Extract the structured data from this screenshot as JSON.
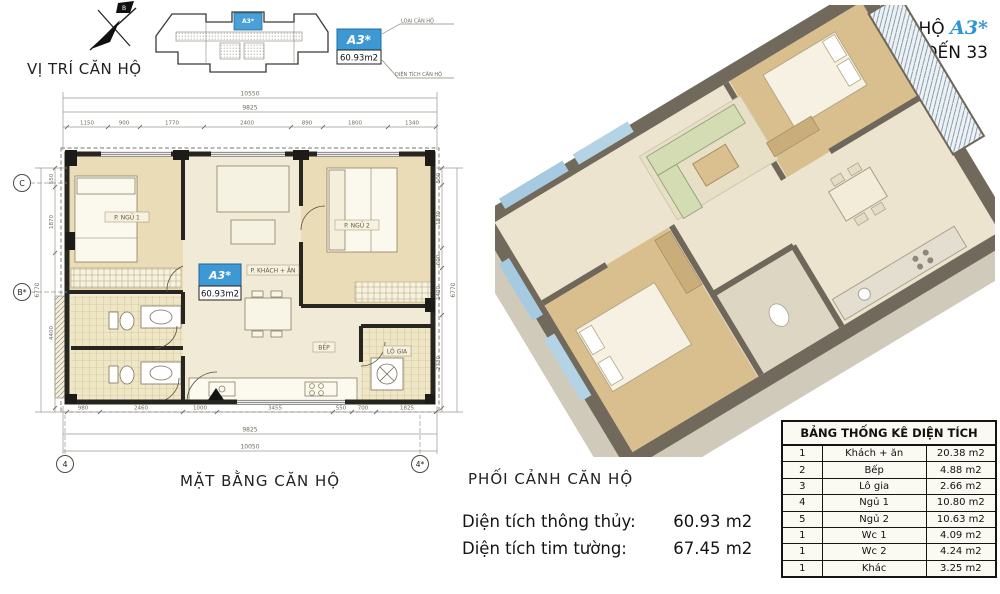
{
  "header": {
    "unit_prefix": "CĂN HỘ",
    "unit_code": "A3*",
    "floor_range": "TẦNG 7 ĐẾN 33"
  },
  "location": {
    "caption": "VỊ TRÍ CĂN HỘ",
    "north_label": "B",
    "keyplan_unit_code": "A3*",
    "badge_code": "A3*",
    "badge_area": "60.93m2",
    "callout_type": "LOẠI CĂN HỘ",
    "callout_area": "DIỆN TÍCH CĂN HỘ"
  },
  "floor_plan": {
    "caption": "MẶT BẰNG CĂN HỘ",
    "unit_code": "A3*",
    "unit_area": "60.93m2",
    "rooms": {
      "bedroom1": "P. NGỦ 1",
      "living": "P. KHÁCH + ĂN",
      "bedroom2": "P. NGỦ 2",
      "kitchen": "BẾP",
      "balcony": "LÔ GIA"
    },
    "grid": {
      "c": "C",
      "b": "B*",
      "four": "4",
      "four_star": "4*"
    },
    "dims": {
      "top_total": "10550",
      "top_sub": "9825",
      "top_segments": [
        "1150",
        "900",
        "1770",
        "2400",
        "890",
        "1800",
        "1340"
      ],
      "bottom_segments": [
        "980",
        "2460",
        "1000",
        "3455",
        "550",
        "700",
        "1825"
      ],
      "bottom_sub": "9825",
      "bottom_total": "10050",
      "left_total": "6770",
      "left_segments": [
        "550",
        "1870",
        "4400"
      ],
      "right_total": "6770",
      "right_segments": [
        "500",
        "1870",
        "600",
        "1400",
        "2730"
      ]
    }
  },
  "perspective": {
    "caption": "PHỐI CẢNH CĂN HỘ"
  },
  "areas": {
    "net_label": "Diện tích thông thủy:",
    "net_value": "60.93 m2",
    "gross_label": "Diện tích tim tường:",
    "gross_value": "67.45 m2"
  },
  "area_table": {
    "title": "BẢNG THỐNG KÊ DIỆN TÍCH",
    "rows": [
      {
        "no": "1",
        "name": "Khách + ăn",
        "area": "20.38 m2"
      },
      {
        "no": "2",
        "name": "Bếp",
        "area": "4.88 m2"
      },
      {
        "no": "3",
        "name": "Lô gia",
        "area": "2.66 m2"
      },
      {
        "no": "4",
        "name": "Ngủ 1",
        "area": "10.80 m2"
      },
      {
        "no": "5",
        "name": "Ngủ 2",
        "area": "10.63 m2"
      },
      {
        "no": "1",
        "name": "Wc 1",
        "area": "4.09 m2"
      },
      {
        "no": "1",
        "name": "Wc 2",
        "area": "4.24 m2"
      },
      {
        "no": "1",
        "name": "Khác",
        "area": "3.25 m2"
      }
    ]
  },
  "colors": {
    "accent_blue": "#3e98d4",
    "wall_black": "#26251f",
    "floor_beige": "#f1ead6",
    "wood_tan": "#e9dcb6"
  }
}
